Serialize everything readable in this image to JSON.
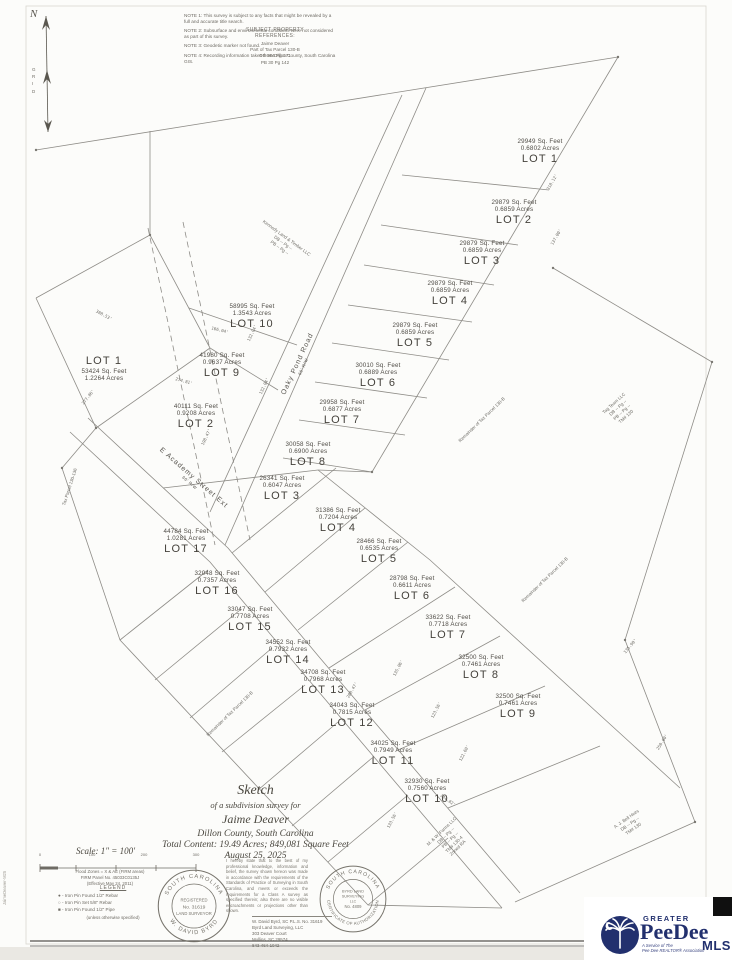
{
  "colors": {
    "line": "#8e8c87",
    "accent_navy": "#22306e",
    "paper": "#fcfcfa"
  },
  "north_arrow": {
    "label": "N",
    "stack": [
      "G",
      "R",
      "I",
      "D"
    ]
  },
  "notes": [
    "NOTE 1: This survey is subject to any facts that might be revealed by a full and accurate title search.",
    "NOTE 2: Subsurface and environmental conditions were not considered as part of this survey.",
    "NOTE 3: Geodetic marker not found.",
    "NOTE 4: Recording information taken from Dillon County, South Carolina GIS."
  ],
  "refs": {
    "title1": "SUBJECT PROPERTY",
    "title2": "REFERENCES:",
    "lines": [
      "Jaime Deaver",
      "Part of Tax Parcel 130-B",
      "DB 964 Pg 171",
      "PB 30 Pg 142"
    ]
  },
  "roads": [
    {
      "name": "Oaky Pond Road",
      "rw": "66' R/W",
      "x": 300,
      "y": 365,
      "rot": -65
    },
    {
      "name": "E Academy Street Ext",
      "rw": "66' R/W",
      "x": 192,
      "y": 480,
      "rot": 41
    }
  ],
  "lots": [
    {
      "name": "LOT 1",
      "sqft": "29949 Sq. Feet",
      "acres": "0.6802 Acres",
      "x": 540,
      "y": 152
    },
    {
      "name": "LOT 2",
      "sqft": "29879 Sq. Feet",
      "acres": "0.6859 Acres",
      "x": 514,
      "y": 213
    },
    {
      "name": "LOT 3",
      "sqft": "29879 Sq. Feet",
      "acres": "0.6859 Acres",
      "x": 482,
      "y": 254
    },
    {
      "name": "LOT 4",
      "sqft": "29879 Sq. Feet",
      "acres": "0.6859 Acres",
      "x": 450,
      "y": 294
    },
    {
      "name": "LOT 5",
      "sqft": "29879 Sq. Feet",
      "acres": "0.6859 Acres",
      "x": 415,
      "y": 336
    },
    {
      "name": "LOT 6",
      "sqft": "30010 Sq. Feet",
      "acres": "0.6889 Acres",
      "x": 378,
      "y": 376
    },
    {
      "name": "LOT 7",
      "sqft": "29958 Sq. Feet",
      "acres": "0.6877 Acres",
      "x": 342,
      "y": 413
    },
    {
      "name": "LOT 8",
      "sqft": "30058 Sq. Feet",
      "acres": "0.6900 Acres",
      "x": 308,
      "y": 455
    },
    {
      "name": "LOT 10",
      "sqft": "58995 Sq. Feet",
      "acres": "1.3543 Acres",
      "x": 252,
      "y": 317
    },
    {
      "name": "LOT 9",
      "sqft": "41980 Sq. Feet",
      "acres": "0.9637 Acres",
      "x": 222,
      "y": 366
    },
    {
      "name": "LOT 2",
      "sqft": "40111 Sq. Feet",
      "acres": "0.9208 Acres",
      "x": 196,
      "y": 417
    },
    {
      "name": "LOT 1",
      "sqft": "53424 Sq. Feet",
      "acres": "1.2264 Acres",
      "x": 104,
      "y": 368,
      "nameFirst": true
    },
    {
      "name": "LOT 3",
      "sqft": "26341 Sq. Feet",
      "acres": "0.6047 Acres",
      "x": 282,
      "y": 489
    },
    {
      "name": "LOT 4",
      "sqft": "31386 Sq. Feet",
      "acres": "0.7204 Acres",
      "x": 338,
      "y": 521
    },
    {
      "name": "LOT 5",
      "sqft": "28466 Sq. Feet",
      "acres": "0.6535 Acres",
      "x": 379,
      "y": 552
    },
    {
      "name": "LOT 6",
      "sqft": "28798 Sq. Feet",
      "acres": "0.6611 Acres",
      "x": 412,
      "y": 589
    },
    {
      "name": "LOT 7",
      "sqft": "33622 Sq. Feet",
      "acres": "0.7718 Acres",
      "x": 448,
      "y": 628
    },
    {
      "name": "LOT 8",
      "sqft": "32500 Sq. Feet",
      "acres": "0.7461 Acres",
      "x": 481,
      "y": 668
    },
    {
      "name": "LOT 9",
      "sqft": "32500 Sq. Feet",
      "acres": "0.7461 Acres",
      "x": 518,
      "y": 707
    },
    {
      "name": "LOT 17",
      "sqft": "44784 Sq. Feet",
      "acres": "1.0281 Acres",
      "x": 186,
      "y": 542
    },
    {
      "name": "LOT 16",
      "sqft": "32048 Sq. Feet",
      "acres": "0.7357 Acres",
      "x": 217,
      "y": 584
    },
    {
      "name": "LOT 15",
      "sqft": "33047 Sq. Feet",
      "acres": "0.7708 Acres",
      "x": 250,
      "y": 620
    },
    {
      "name": "LOT 14",
      "sqft": "34552 Sq. Feet",
      "acres": "0.7932 Acres",
      "x": 288,
      "y": 653
    },
    {
      "name": "LOT 13",
      "sqft": "34708 Sq. Feet",
      "acres": "0.7968 Acres",
      "x": 323,
      "y": 683
    },
    {
      "name": "LOT 12",
      "sqft": "34043 Sq. Feet",
      "acres": "0.7815 Acres",
      "x": 352,
      "y": 716
    },
    {
      "name": "LOT 11",
      "sqft": "34025 Sq. Feet",
      "acres": "0.7949 Acres",
      "x": 393,
      "y": 754
    },
    {
      "name": "LOT 10",
      "sqft": "32930 Sq. Feet",
      "acres": "0.7560 Acres",
      "x": 427,
      "y": 792
    }
  ],
  "dims": [
    {
      "t": "318.12'",
      "x": 552,
      "y": 182,
      "r": -60
    },
    {
      "t": "137.00'",
      "x": 556,
      "y": 237,
      "r": -60
    },
    {
      "t": "132.04'",
      "x": 252,
      "y": 333,
      "r": -65
    },
    {
      "t": "132.04'",
      "x": 264,
      "y": 386,
      "r": -65
    },
    {
      "t": "166.04'",
      "x": 220,
      "y": 330,
      "r": 14
    },
    {
      "t": "274.81'",
      "x": 184,
      "y": 381,
      "r": 15
    },
    {
      "t": "198.47'",
      "x": 206,
      "y": 437,
      "r": -65
    },
    {
      "t": "388.53'",
      "x": 104,
      "y": 315,
      "r": 28
    },
    {
      "t": "277.86'",
      "x": 88,
      "y": 397,
      "r": -52
    },
    {
      "t": "288.47'",
      "x": 352,
      "y": 690,
      "r": -60
    },
    {
      "t": "135.06'",
      "x": 398,
      "y": 668,
      "r": -63
    },
    {
      "t": "123.56'",
      "x": 436,
      "y": 710,
      "r": -63
    },
    {
      "t": "122.60'",
      "x": 464,
      "y": 753,
      "r": -63
    },
    {
      "t": "244.82'",
      "x": 448,
      "y": 800,
      "r": 36
    },
    {
      "t": "133.56'",
      "x": 392,
      "y": 820,
      "r": -63
    },
    {
      "t": "135.90'",
      "x": 630,
      "y": 646,
      "r": -50
    },
    {
      "t": "250.00'",
      "x": 662,
      "y": 742,
      "r": -58
    }
  ],
  "adjoiners": [
    {
      "x": 283,
      "y": 243,
      "r": 36,
      "lines": [
        "Kennedy Land & Timber LLC",
        "DB -- Pg --",
        "PB -- Pg --"
      ]
    },
    {
      "x": 482,
      "y": 420,
      "r": -44,
      "lines": [
        "Remainder of Tax Parcel 130-B"
      ]
    },
    {
      "x": 545,
      "y": 580,
      "r": -44,
      "lines": [
        "Remainder of Tax Parcel 130-B"
      ]
    },
    {
      "x": 230,
      "y": 714,
      "r": -44,
      "lines": [
        "Remainder of Tax Parcel 130-B"
      ]
    },
    {
      "x": 70,
      "y": 487,
      "r": -72,
      "lines": [
        "Tax Parcel 130-136"
      ]
    },
    {
      "x": 620,
      "y": 410,
      "r": -42,
      "lines": [
        "Tag Team LLC",
        "DB -- Pg --",
        "PB -- Pg --",
        "TM# 130"
      ]
    },
    {
      "x": 450,
      "y": 840,
      "r": -44,
      "lines": [
        "M. & W. Farms LLC",
        "DB -- Pg --",
        "PB -- Pg --",
        "TM# 130-4",
        "Zoned RA"
      ]
    },
    {
      "x": 630,
      "y": 824,
      "r": -35,
      "lines": [
        "A. J. Bell Heirs",
        "DB -- Pg --",
        "TM# 130"
      ]
    }
  ],
  "title_block": {
    "line1": "Sketch",
    "line2": "of a subdivision survey for",
    "name": "Jaime Deaver",
    "line3": "Dillon County, South Carolina",
    "line4": "Total Content: 19.49 Acres; 849,081 Square Feet",
    "date": "August 25, 2025",
    "scale": "Scale: 1\" = 100'"
  },
  "scale_bar_labels": [
    "0",
    "100",
    "200",
    "300"
  ],
  "flood_note": [
    "Flood Zones = X & AE (FIRM areas)",
    "FIRM Panel No. 45033C0135J",
    "(Effective May 24, 2011)"
  ],
  "legend": {
    "title": "LEGEND",
    "items": [
      {
        "sym": "●",
        "text": "-  Iron Pin Found 1/2\" Rebar"
      },
      {
        "sym": "○",
        "text": "-  Iron Pin Set 5/8\" Rebar"
      },
      {
        "sym": "■",
        "text": "-  Iron Pin Found 1/2\" Pipe"
      }
    ],
    "note": "(unless otherwise specified)"
  },
  "seal1": {
    "arc_top": "SOUTH CAROLINA",
    "arc_bottom": "W. DAVID BYRD",
    "mid1": "REGISTERED",
    "num": "No. 31619",
    "mid2": "LAND SURVEYOR"
  },
  "seal2": {
    "arc_top": "SOUTH CAROLINA",
    "arc_bottom": "CERTIFICATE OF AUTHORIZATION",
    "mid1": "BYRD LAND",
    "mid2": "SURVEYING",
    "mid3": "LLC",
    "num": "No. 4809"
  },
  "certification": "I hereby state that to the best of my professional knowledge, information and belief, the survey shown hereon was made in accordance with the requirements of the Standards of Practice of Surveying in South Carolina, and meets or exceeds the requirements for a Class A survey as specified therein; also there are no visible encroachments or projections other than shown.",
  "surveyor": [
    "W. David Byrd, SC P.L.S. No. 31619",
    "Byrd Land Surveying, LLC",
    "303 Deaver Court",
    "Mullins, SC 29574",
    "843-464-1042"
  ],
  "watermark": "JaimeDeaver-M25",
  "mls": {
    "greater": "GREATER",
    "peedee": "PeeDee",
    "mls": "MLS",
    "tagline1": "A Service of The",
    "tagline2": "Pee Dee REALTOR® Association"
  }
}
